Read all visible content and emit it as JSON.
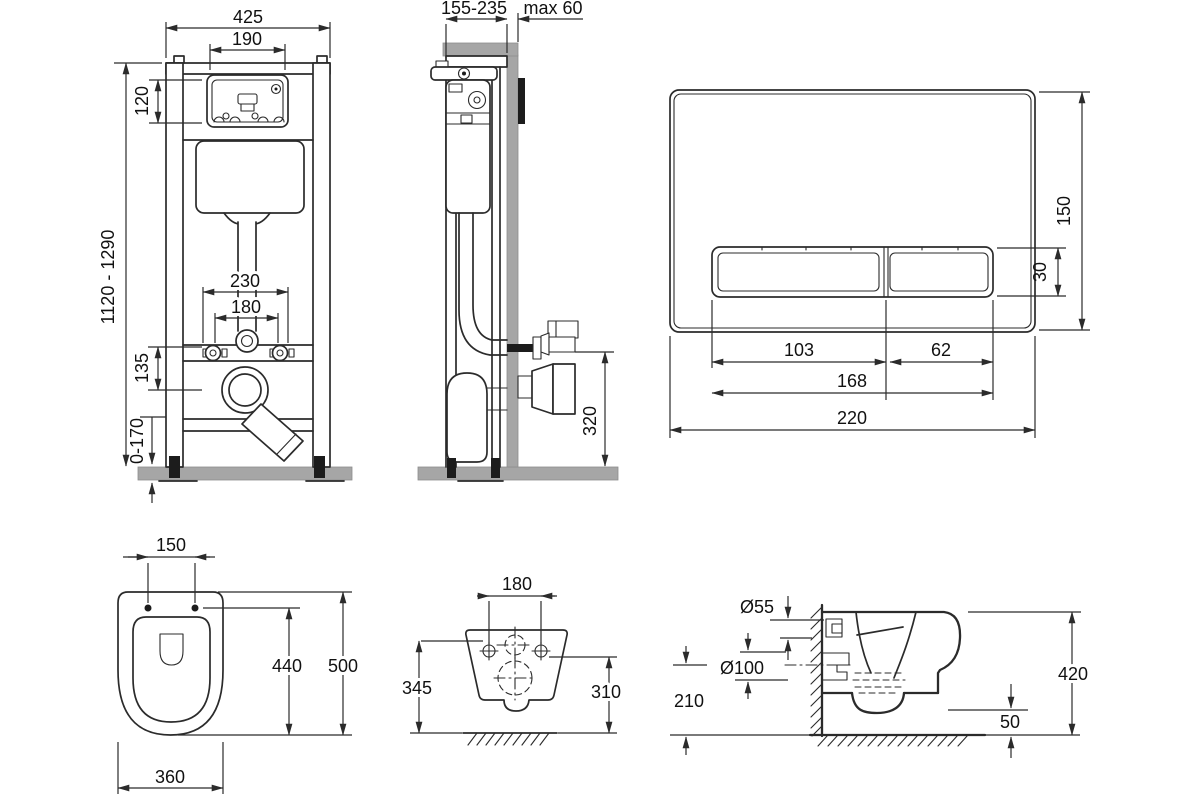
{
  "drawing": "wall-hung-toilet-installation-dimensions",
  "colors": {
    "line": "#2b2b2b",
    "wall_gray": "#a6a6a6",
    "plate_edge": "#1c1c1c",
    "background": "#ffffff"
  },
  "dims": {
    "frame_front": {
      "total_width": "425",
      "window_width": "190",
      "window_height": "120",
      "frame_height_range": "1120 - 1290",
      "fixing_spacing_outer": "230",
      "fixing_spacing_inner": "180",
      "outlet_drop": "135",
      "foot_adjustment": "0-170"
    },
    "frame_side": {
      "depth_range": "155-235",
      "max_wall_thickness": "max 60",
      "inlet_height": "320"
    },
    "flush_plate": {
      "plate_height": "150",
      "button_height": "30",
      "left_button_width": "103",
      "right_button_width": "62",
      "buttons_width": "168",
      "plate_width": "220"
    },
    "bowl_top": {
      "hole_spacing": "150",
      "inner_length": "440",
      "length": "500",
      "width": "360"
    },
    "bowl_rear": {
      "hole_spacing": "180",
      "height_left": "345",
      "height_right": "310"
    },
    "bowl_side": {
      "inlet_diameter": "Ø55",
      "outlet_diameter": "Ø100",
      "outlet_height": "210",
      "height": "420",
      "floor_clearance": "50"
    }
  }
}
